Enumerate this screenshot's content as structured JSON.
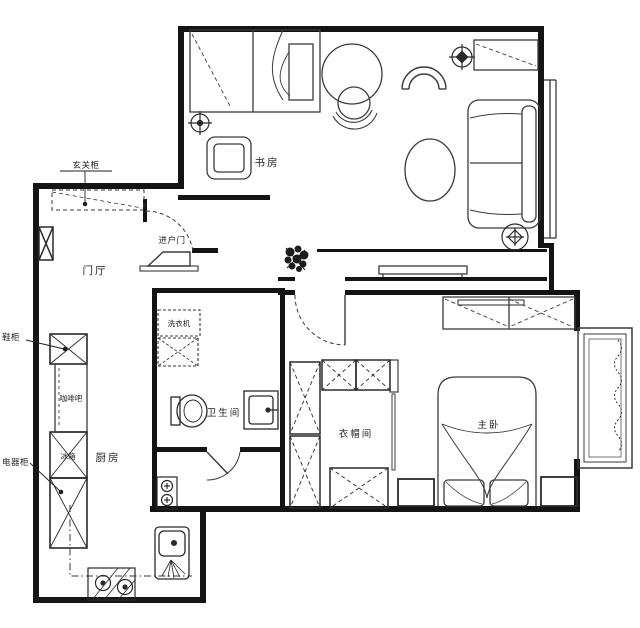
{
  "meta": {
    "type": "apartment-floor-plan",
    "style": "black-and-white CAD line drawing"
  },
  "colors": {
    "background": "#ffffff",
    "walls": "#141414",
    "furniture_lines": "#3a3a3a",
    "labels": "#1f1f1f"
  },
  "rooms": {
    "study": {
      "label": "书房"
    },
    "foyer": {
      "label": "门厅"
    },
    "kitchen": {
      "label": "厨房"
    },
    "bathroom": {
      "label": "卫生间"
    },
    "cloakroom": {
      "label": "衣帽间"
    },
    "master_bedroom": {
      "label": "主卧"
    }
  },
  "annotations": {
    "entry_cabinet": {
      "label": "玄关柜"
    },
    "entry_door": {
      "label": "进户门"
    },
    "shoe_cabinet": {
      "label": "鞋柜"
    },
    "coffee_bar": {
      "label": "咖啡吧"
    },
    "fridge": {
      "label": "冰箱"
    },
    "appliance_cabinet": {
      "label": "电器柜"
    },
    "washing_machine": {
      "label": "洗衣机"
    }
  }
}
